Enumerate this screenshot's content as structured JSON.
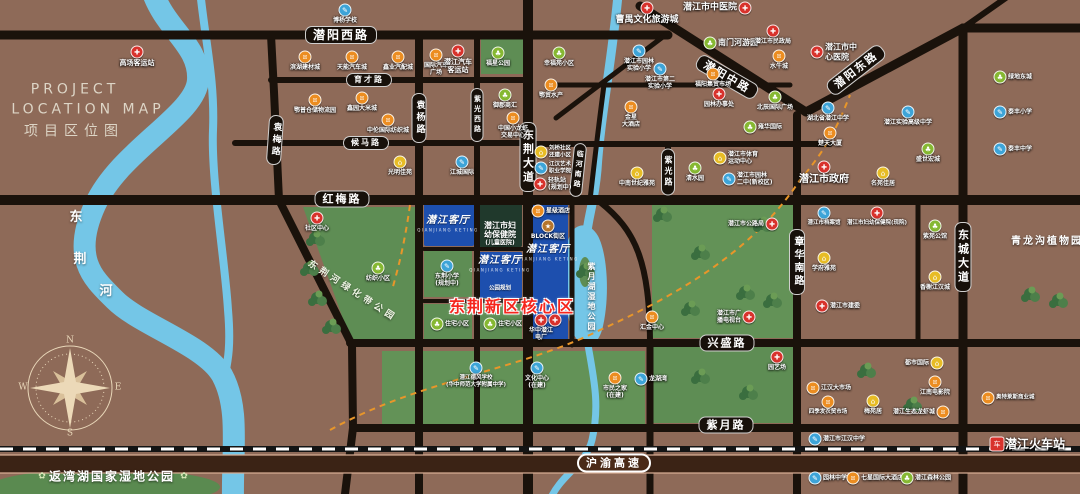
{
  "title": {
    "en1": "PROJECT",
    "en2": "LOCATION MAP",
    "cn": "项目区位图"
  },
  "compass": {
    "n": "N",
    "s": "S",
    "e": "E",
    "w": "W"
  },
  "colors": {
    "background": "#8e6a58",
    "road": "#1a120b",
    "water": "#74c6e7",
    "park": "#5e8d54",
    "project_block_blue": "#1d4fae",
    "hospital_block": "#20392c",
    "highway_band": "#3b2315",
    "core_text_red": "#f5261d",
    "poi_hospital_red": "#d8322c",
    "poi_school_blue": "#3da4d8",
    "poi_market_orange": "#ec8d21",
    "poi_park_green": "#86b832",
    "poi_residence_yellow": "#e7bc25",
    "poi_block_brown": "#b5752c"
  },
  "poi_styles": {
    "red": {
      "color": "#d8322c",
      "glyph": "✚",
      "icon": "red-cross-icon"
    },
    "blue": {
      "color": "#3da4d8",
      "glyph": "✎",
      "icon": "school-icon"
    },
    "orange": {
      "color": "#ec8d21",
      "glyph": "¤",
      "icon": "market-icon"
    },
    "green": {
      "color": "#86b832",
      "glyph": "♣",
      "icon": "park-icon"
    },
    "yellow": {
      "color": "#e7bc25",
      "glyph": "⌂",
      "icon": "residence-icon"
    },
    "brown": {
      "color": "#b5752c",
      "glyph": "★",
      "icon": "block-icon"
    },
    "station": {
      "color": "#d8322c",
      "glyph": "车",
      "icon": "train-station-icon"
    }
  },
  "road_labels": [
    {
      "text": "潜阳西路",
      "x": 341,
      "y": 35,
      "orient": "h",
      "fs": 12
    },
    {
      "text": "育才路",
      "x": 369,
      "y": 80,
      "orient": "h",
      "fs": 8
    },
    {
      "text": "候马路",
      "x": 366,
      "y": 143,
      "orient": "h",
      "fs": 8
    },
    {
      "text": "红梅路",
      "x": 342,
      "y": 199,
      "orient": "h",
      "fs": 11
    },
    {
      "text": "兴盛路",
      "x": 727,
      "y": 343,
      "orient": "h",
      "fs": 11
    },
    {
      "text": "紫月路",
      "x": 726,
      "y": 425,
      "orient": "h",
      "fs": 11
    },
    {
      "text": "潜阳中路",
      "x": 727,
      "y": 77,
      "orient": "h",
      "fs": 11,
      "rot": 30
    },
    {
      "text": "潜阳东路",
      "x": 856,
      "y": 70,
      "orient": "h",
      "fs": 11,
      "rot": -38
    },
    {
      "text": "沪渝高速",
      "x": 614,
      "y": 463,
      "orient": "h",
      "fs": 11,
      "style": "hwy"
    },
    {
      "text": "袁梅路",
      "x": 275,
      "y": 140,
      "orient": "v",
      "fs": 9,
      "rot": 4
    },
    {
      "text": "袁杨路",
      "x": 419,
      "y": 118,
      "orient": "v",
      "fs": 9
    },
    {
      "text": "紫光西路",
      "x": 477,
      "y": 115,
      "orient": "v",
      "fs": 7
    },
    {
      "text": "东荆大道",
      "x": 528,
      "y": 157,
      "orient": "v",
      "fs": 11
    },
    {
      "text": "临河南路",
      "x": 578,
      "y": 170,
      "orient": "v",
      "fs": 7,
      "rot": 6
    },
    {
      "text": "紫光路",
      "x": 668,
      "y": 172,
      "orient": "v",
      "fs": 8
    },
    {
      "text": "章华南路",
      "x": 797,
      "y": 262,
      "orient": "v",
      "fs": 10
    },
    {
      "text": "东城大道",
      "x": 963,
      "y": 257,
      "orient": "v",
      "fs": 11
    }
  ],
  "area_texts": [
    {
      "name": "title-en-1",
      "text": "PROJECT",
      "x": 75,
      "y": 90,
      "cls": "t-title-en"
    },
    {
      "name": "title-en-2",
      "text": "LOCATION MAP",
      "x": 88,
      "y": 110,
      "cls": "t-title-en"
    },
    {
      "name": "title-cn",
      "text": "项目区位图",
      "x": 74,
      "y": 132,
      "cls": "t-title-cn"
    },
    {
      "name": "river-name",
      "text": "东",
      "x": 76,
      "y": 218,
      "cls": "t-river"
    },
    {
      "name": "river-name",
      "text": "荆",
      "x": 80,
      "y": 260,
      "cls": "t-river"
    },
    {
      "name": "river-name",
      "text": "河",
      "x": 106,
      "y": 292,
      "cls": "t-river"
    },
    {
      "name": "greenbelt-park-label",
      "text": "东荆河绿化带公园",
      "x": 352,
      "y": 292,
      "cls": "t-parklabel",
      "rot": 33
    },
    {
      "name": "lake-park-label",
      "text": "紫月湖湿地公园",
      "x": 591,
      "y": 297,
      "cls": "t-lake"
    },
    {
      "name": "plant-garden-label",
      "text": "青龙沟植物园",
      "x": 1047,
      "y": 242,
      "cls": "t-parkbig"
    },
    {
      "name": "wetland-park-label",
      "text": "返湾湖国家湿地公园",
      "x": 112,
      "y": 477,
      "cls": "t-wetland"
    },
    {
      "name": "flower-icon",
      "text": "✿",
      "x": 42,
      "y": 477,
      "cls": "t-flower"
    },
    {
      "name": "flower-icon",
      "text": "✿",
      "x": 184,
      "y": 477,
      "cls": "t-flower"
    },
    {
      "name": "core-area-title",
      "text": "东荆新区核心区",
      "x": 512,
      "y": 307,
      "cls": "t-core"
    },
    {
      "name": "project-script",
      "text": "潜江客厅",
      "x": 448,
      "y": 221,
      "cls": "t-script"
    },
    {
      "name": "project-script",
      "text": "潜江客厅",
      "x": 548,
      "y": 250,
      "cls": "t-script"
    },
    {
      "name": "project-script",
      "text": "潜江客厅",
      "x": 500,
      "y": 261,
      "cls": "t-script"
    },
    {
      "name": "project-caption",
      "text": "QIANJIANG KETING",
      "x": 448,
      "y": 230,
      "cls": "t-caption"
    },
    {
      "name": "project-caption",
      "text": "QIANJIANG KETING",
      "x": 548,
      "y": 259,
      "cls": "t-caption"
    },
    {
      "name": "project-caption",
      "text": "QIANJIANG KETING",
      "x": 500,
      "y": 270,
      "cls": "t-caption"
    },
    {
      "name": "hospital-block-label",
      "text": "潜江市妇",
      "x": 500,
      "y": 226,
      "cls": "t-blockline"
    },
    {
      "name": "hospital-block-label",
      "text": "幼保健院",
      "x": 500,
      "y": 235,
      "cls": "t-blockline"
    },
    {
      "name": "hospital-block-label",
      "text": "(儿童医院)",
      "x": 500,
      "y": 243,
      "cls": "t-blockline",
      "fs": 6
    },
    {
      "name": "park-plan-label",
      "text": "公园规划",
      "x": 500,
      "y": 289,
      "cls": "t-blockline",
      "fs": 5.5
    },
    {
      "name": "compass-letter-n",
      "text": "N",
      "x": 70,
      "y": 341,
      "cls": "t-compass"
    },
    {
      "name": "compass-letter-s",
      "text": "S",
      "x": 70,
      "y": 434,
      "cls": "t-compass"
    },
    {
      "name": "compass-letter-e",
      "text": "E",
      "x": 118,
      "y": 388,
      "cls": "t-compass"
    },
    {
      "name": "compass-letter-w",
      "text": "W",
      "x": 23,
      "y": 388,
      "cls": "t-compass"
    }
  ],
  "pois": [
    {
      "text": "博杨学校",
      "x": 345,
      "y": 10,
      "type": "blue"
    },
    {
      "text": "高场客运站",
      "x": 137,
      "y": 52,
      "type": "red",
      "fs": 7,
      "bold": true
    },
    {
      "text": "滨湖建材城",
      "x": 305,
      "y": 57,
      "type": "orange"
    },
    {
      "text": "天能汽车城",
      "x": 352,
      "y": 57,
      "type": "orange"
    },
    {
      "text": "鑫业汽配城",
      "x": 398,
      "y": 57,
      "type": "orange"
    },
    {
      "text": "国际汽车\n广场",
      "x": 436,
      "y": 55,
      "type": "orange"
    },
    {
      "text": "鄂普仓储物流园",
      "x": 315,
      "y": 100,
      "type": "orange"
    },
    {
      "text": "鑫园大米城",
      "x": 362,
      "y": 98,
      "type": "orange"
    },
    {
      "text": "中伦国际纺织城",
      "x": 388,
      "y": 120,
      "type": "orange"
    },
    {
      "text": "潜江汽车\n客运站",
      "x": 458,
      "y": 51,
      "type": "red",
      "fs": 7,
      "bold": true
    },
    {
      "text": "福星公园",
      "x": 498,
      "y": 53,
      "type": "green"
    },
    {
      "text": "幸福苑小区",
      "x": 559,
      "y": 53,
      "type": "green"
    },
    {
      "text": "鄂贸水产",
      "x": 551,
      "y": 85,
      "type": "orange"
    },
    {
      "text": "御郡商汇",
      "x": 505,
      "y": 95,
      "type": "green"
    },
    {
      "text": "中国小龙虾\n交易中心",
      "x": 513,
      "y": 118,
      "type": "orange"
    },
    {
      "text": "光明佳苑",
      "x": 400,
      "y": 162,
      "type": "yellow"
    },
    {
      "text": "江城国际",
      "x": 462,
      "y": 162,
      "type": "blue"
    },
    {
      "text": "潜江市园林\n实验小学",
      "x": 639,
      "y": 51,
      "type": "blue"
    },
    {
      "text": "潜江市第二\n实验小学",
      "x": 660,
      "y": 69,
      "type": "blue"
    },
    {
      "text": "南门河游园",
      "x": 710,
      "y": 43,
      "type": "green",
      "pos": "r",
      "fs": 8,
      "bold": true
    },
    {
      "text": "曹禺文化旅游城",
      "x": 647,
      "y": 8,
      "type": "red",
      "fs": 9,
      "bold": true
    },
    {
      "text": "潜江市中医院",
      "x": 745,
      "y": 8,
      "type": "red",
      "pos": "l",
      "fs": 9,
      "bold": true
    },
    {
      "text": "潜江市民政局",
      "x": 773,
      "y": 31,
      "type": "red"
    },
    {
      "text": "水牛城",
      "x": 779,
      "y": 56,
      "type": "orange"
    },
    {
      "text": "福阳集贸市场",
      "x": 713,
      "y": 74,
      "type": "orange"
    },
    {
      "text": "园林办事处",
      "x": 719,
      "y": 94,
      "type": "red"
    },
    {
      "text": "北辰国际广场",
      "x": 775,
      "y": 97,
      "type": "green"
    },
    {
      "text": "潜江市中\n心医院",
      "x": 817,
      "y": 52,
      "type": "red",
      "pos": "r",
      "fs": 8,
      "bold": true
    },
    {
      "text": "湖北省潜江中学",
      "x": 828,
      "y": 108,
      "type": "blue"
    },
    {
      "text": "潜江实验高级中学",
      "x": 908,
      "y": 112,
      "type": "blue"
    },
    {
      "text": "绿地东城",
      "x": 1000,
      "y": 77,
      "type": "green",
      "pos": "r"
    },
    {
      "text": "泰丰小学",
      "x": 1000,
      "y": 112,
      "type": "blue",
      "pos": "r"
    },
    {
      "text": "泰丰中学",
      "x": 1000,
      "y": 149,
      "type": "blue",
      "pos": "r"
    },
    {
      "text": "盛世宏城",
      "x": 928,
      "y": 149,
      "type": "green"
    },
    {
      "text": "名苑佳居",
      "x": 883,
      "y": 173,
      "type": "yellow"
    },
    {
      "text": "楚天大厦",
      "x": 830,
      "y": 133,
      "type": "orange"
    },
    {
      "text": "潜江市政府",
      "x": 824,
      "y": 167,
      "type": "red",
      "fs": 10,
      "bold": true
    },
    {
      "text": "金星\n大酒店",
      "x": 631,
      "y": 107,
      "type": "orange"
    },
    {
      "text": "刘桥社区\n还建小区",
      "x": 541,
      "y": 152,
      "type": "yellow",
      "pos": "r",
      "fs": 5.5
    },
    {
      "text": "江汉艺术\n职业学院",
      "x": 541,
      "y": 168,
      "type": "blue",
      "pos": "r",
      "fs": 5.5
    },
    {
      "text": "轻轨站\n(规划中)",
      "x": 540,
      "y": 184,
      "type": "red",
      "pos": "r",
      "fs": 6,
      "bold": true
    },
    {
      "text": "社区中心",
      "x": 317,
      "y": 218,
      "type": "red"
    },
    {
      "text": "纺织小区",
      "x": 378,
      "y": 268,
      "type": "green"
    },
    {
      "text": "住宅小区",
      "x": 437,
      "y": 324,
      "type": "green",
      "pos": "r"
    },
    {
      "text": "住宅小区",
      "x": 490,
      "y": 324,
      "type": "green",
      "pos": "r"
    },
    {
      "text": "东荆小学\n(规划中)",
      "x": 447,
      "y": 266,
      "type": "blue"
    },
    {
      "text": "星级酒店",
      "x": 538,
      "y": 211,
      "type": "orange",
      "pos": "r"
    },
    {
      "text": "BLOCK街区",
      "x": 548,
      "y": 226,
      "type": "brown"
    },
    {
      "text": "",
      "x": 555,
      "y": 320,
      "type": "red"
    },
    {
      "text": "华中潜江\n电厂",
      "x": 541,
      "y": 320,
      "type": "red"
    },
    {
      "text": "潜江德风学校\n(华中师范大学附属中学)",
      "x": 476,
      "y": 368,
      "type": "blue",
      "fs": 5.5
    },
    {
      "text": "文化中心\n(在建)",
      "x": 537,
      "y": 368,
      "type": "blue"
    },
    {
      "text": "市民之家\n(在建)",
      "x": 615,
      "y": 378,
      "type": "orange"
    },
    {
      "text": "龙湖湾",
      "x": 641,
      "y": 379,
      "type": "blue",
      "pos": "r"
    },
    {
      "text": "汇金中心",
      "x": 652,
      "y": 317,
      "type": "orange"
    },
    {
      "text": "雍华国际",
      "x": 750,
      "y": 127,
      "type": "green",
      "pos": "r"
    },
    {
      "text": "潜江市体育\n运动中心",
      "x": 720,
      "y": 158,
      "type": "yellow",
      "pos": "r"
    },
    {
      "text": "潜江市园林\n二中(新校区)",
      "x": 729,
      "y": 179,
      "type": "blue",
      "pos": "r"
    },
    {
      "text": "中南世纪雅苑",
      "x": 637,
      "y": 173,
      "type": "yellow"
    },
    {
      "text": "清水园",
      "x": 695,
      "y": 168,
      "type": "green"
    },
    {
      "text": "潜江市公路局",
      "x": 772,
      "y": 224,
      "type": "red",
      "pos": "l"
    },
    {
      "text": "潜江市妇幼保健院(现院)",
      "x": 877,
      "y": 213,
      "type": "red",
      "fs": 5.5
    },
    {
      "text": "潜江市档案馆",
      "x": 824,
      "y": 213,
      "type": "blue",
      "fs": 5.5
    },
    {
      "text": "紫苑公馆",
      "x": 935,
      "y": 226,
      "type": "green"
    },
    {
      "text": "香榭江汉城",
      "x": 935,
      "y": 277,
      "type": "yellow"
    },
    {
      "text": "学府雅苑",
      "x": 824,
      "y": 258,
      "type": "yellow"
    },
    {
      "text": "潜江市广\n播电视台",
      "x": 749,
      "y": 317,
      "type": "red",
      "pos": "l"
    },
    {
      "text": "潜江市建委",
      "x": 822,
      "y": 306,
      "type": "red",
      "pos": "r"
    },
    {
      "text": "园艺场",
      "x": 777,
      "y": 357,
      "type": "red"
    },
    {
      "text": "江汉大市场",
      "x": 813,
      "y": 388,
      "type": "orange",
      "pos": "r"
    },
    {
      "text": "四季发农贸市场",
      "x": 828,
      "y": 402,
      "type": "orange",
      "fs": 5.5
    },
    {
      "text": "都市国际",
      "x": 937,
      "y": 363,
      "type": "yellow",
      "pos": "l"
    },
    {
      "text": "梅苑居",
      "x": 873,
      "y": 401,
      "type": "yellow"
    },
    {
      "text": "江南电影院",
      "x": 935,
      "y": 382,
      "type": "orange"
    },
    {
      "text": "潜江生态龙虾城",
      "x": 943,
      "y": 412,
      "type": "orange",
      "pos": "l"
    },
    {
      "text": "奥特莱斯商业城",
      "x": 988,
      "y": 398,
      "type": "orange",
      "pos": "r",
      "fs": 5.5
    },
    {
      "text": "潜江市江汉中学",
      "x": 815,
      "y": 439,
      "type": "blue",
      "pos": "r"
    },
    {
      "text": "园林中学",
      "x": 815,
      "y": 478,
      "type": "blue",
      "pos": "r"
    },
    {
      "text": "七星国际大酒店",
      "x": 853,
      "y": 478,
      "type": "orange",
      "pos": "r"
    },
    {
      "text": "潜江森林公园",
      "x": 907,
      "y": 478,
      "type": "green",
      "pos": "r"
    },
    {
      "text": "潜江火车站",
      "x": 997,
      "y": 444,
      "type": "station",
      "pos": "r",
      "fs": 12,
      "bold": true
    }
  ]
}
